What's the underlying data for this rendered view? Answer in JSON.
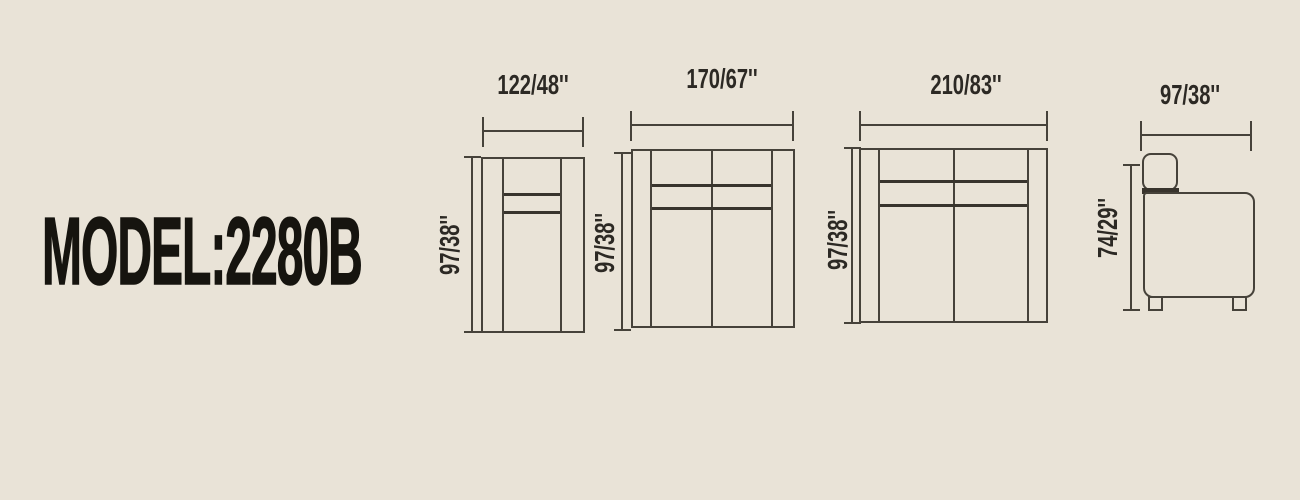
{
  "title": "MODEL:2280B",
  "colors": {
    "background": "#e9e3d7",
    "line": "#46423a",
    "seam": "#38342d",
    "text": "#2c2924",
    "title_text": "#16140f"
  },
  "figures": [
    {
      "name": "single-seat-front-view",
      "width_label": "122/48''",
      "height_label": "97/38''"
    },
    {
      "name": "two-seat-front-view",
      "width_label": "170/67''",
      "height_label": "97/38''"
    },
    {
      "name": "three-seat-front-view",
      "width_label": "210/83''",
      "height_label": "97/38''"
    },
    {
      "name": "side-view",
      "width_label": "97/38''",
      "height_label": "74/29''"
    }
  ]
}
